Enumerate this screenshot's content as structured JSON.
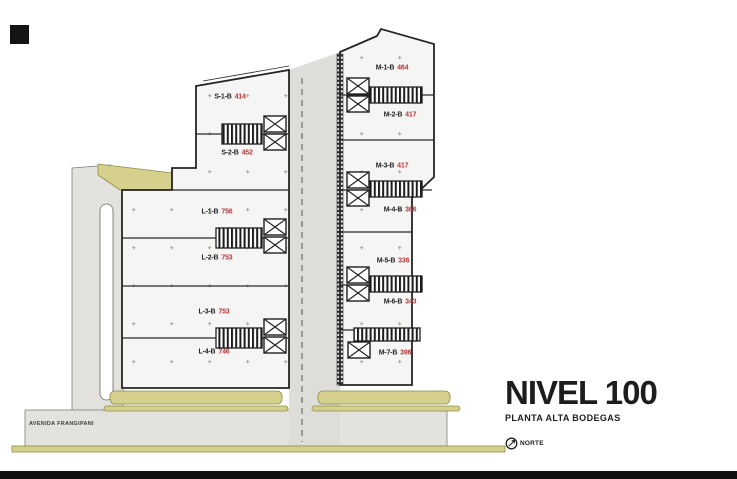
{
  "title_block": {
    "title": "NIVEL 100",
    "subtitle": "PLANTA ALTA BODEGAS",
    "north_label": "NORTE"
  },
  "street": {
    "name": "AVENIDA FRANGIPANI"
  },
  "colors": {
    "road": "#e3e2de",
    "sidewalk_olive": "#d5d18d",
    "sidewalk_edge": "#8f8c4a",
    "building_fill": "#f5f5f3",
    "outline": "#232323",
    "unit_code_color": "#232323",
    "unit_area_color": "#b5383c",
    "footer_bar": "#111111"
  },
  "units": [
    {
      "code": "S-1-B",
      "area": "414",
      "x": 230,
      "y": 97
    },
    {
      "code": "S-2-B",
      "area": "452",
      "x": 237,
      "y": 153
    },
    {
      "code": "L-1-B",
      "area": "756",
      "x": 217,
      "y": 212
    },
    {
      "code": "L-2-B",
      "area": "753",
      "x": 217,
      "y": 258
    },
    {
      "code": "L-3-B",
      "area": "753",
      "x": 214,
      "y": 312
    },
    {
      "code": "L-4-B",
      "area": "746",
      "x": 214,
      "y": 352
    },
    {
      "code": "M-1-B",
      "area": "464",
      "x": 392,
      "y": 68
    },
    {
      "code": "M-2-B",
      "area": "417",
      "x": 400,
      "y": 115
    },
    {
      "code": "M-3-B",
      "area": "417",
      "x": 392,
      "y": 166
    },
    {
      "code": "M-4-B",
      "area": "366",
      "x": 400,
      "y": 210
    },
    {
      "code": "M-5-B",
      "area": "336",
      "x": 393,
      "y": 261
    },
    {
      "code": "M-6-B",
      "area": "343",
      "x": 400,
      "y": 302
    },
    {
      "code": "M-7-B",
      "area": "396",
      "x": 395,
      "y": 353
    }
  ]
}
